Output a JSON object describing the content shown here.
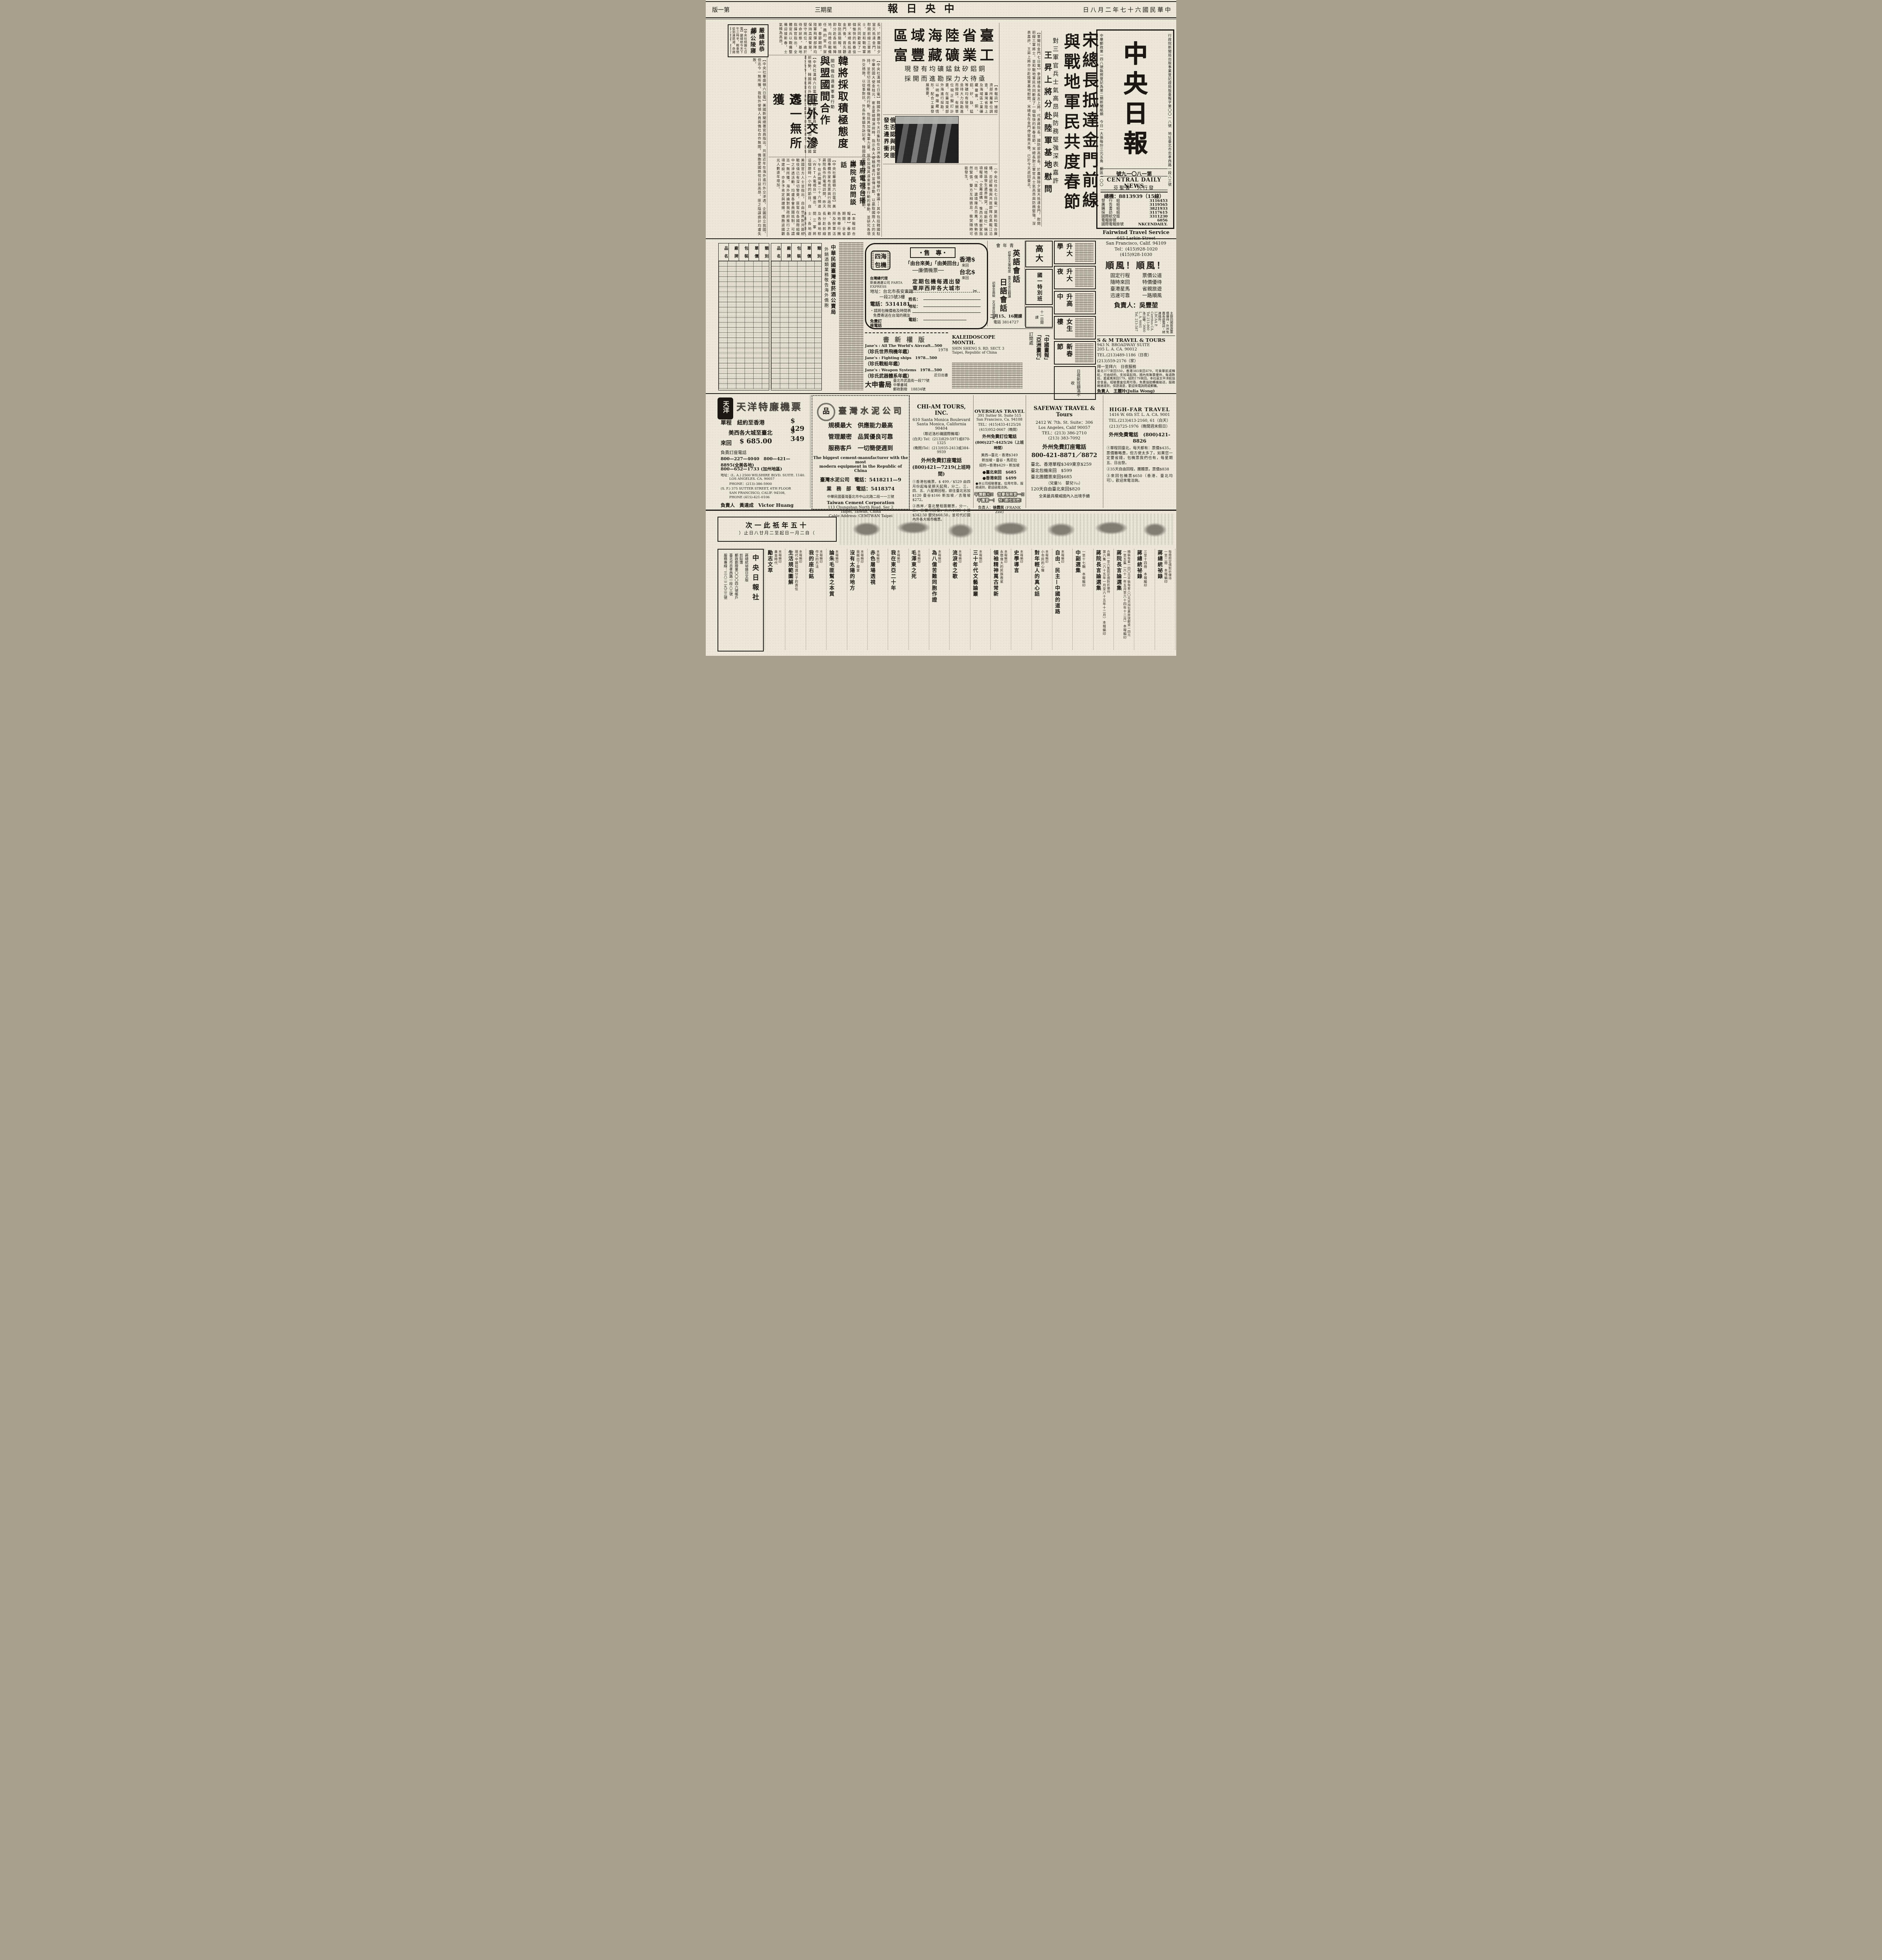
{
  "page": {
    "edition": "第一版",
    "weekday": "星期三",
    "title": "中央日報",
    "date": "中華民國六十七年二月八日"
  },
  "masthead": {
    "reg_line": "行政院新聞局出版事業登記證局版臺報字第〇〇一八號　地址臺北市忠孝西路一段八三號",
    "postal_line": "中華郵政第一四八號執照登記為第二類新聞紙類　今日一大張每份三元五角　郵區一〇〇",
    "big_title": "中央日報",
    "issue_no": "第一八〇一九號",
    "en_name": "CENTRAL DAILY NEWS",
    "publisher": "發行人　曹聖芬",
    "switchboard": "總機：8813939（15線）",
    "phones": [
      {
        "label": "發　行　組",
        "value": "3116453"
      },
      {
        "label": "廣　告　組",
        "value": "3119565"
      },
      {
        "label": "購　書　組",
        "value": "3821933"
      },
      {
        "label": "採　訪　組",
        "value": "3117615"
      },
      {
        "label": "國際航空版",
        "value": "3311230"
      },
      {
        "label": "電報掛號",
        "value": "6056"
      },
      {
        "label": "國際電報掛號",
        "value": "NKCENDAILY."
      }
    ]
  },
  "news": {
    "song": {
      "h1": "宋總長抵達金門前線",
      "h2": "與戰地軍民共度春節",
      "kicker": "對三軍官兵士氣高昂與防務堅強深表嘉許",
      "sub": "王昇上將分赴陸軍基地慰問",
      "body": "【軍聞社金門七日電】參謀總長宋長志上將，代表蔣院長、國防部高部長，於農曆除夕當天抵達金門，慰問前線三軍將士，並和戰地軍民共同歡度了一個愉快的新春佳節。宋總長對三軍官兵士氣高昂與防務堅強，深表嘉許。王昇上將亦分赴陸軍基地慰問。宋總長在金門停留兩天後，已於今天返回臺北。"
    },
    "minerals": {
      "h1": "臺省陸海域區",
      "h2": "工業礦藏豐富",
      "sub1": "銅鋁矽鈦錳礦均有發現",
      "sub2": "亟待大力探勘進而開採",
      "body": "【本報訊】據經濟部所屬單位調查，臺灣省陸上及海域區工業礦藏豐富，銅、鋁、矽、鈦、錳等礦均有發現，亟待大力探勘進而開採。有關單位現正擬訂計畫，在臺灣東部外海進行探勘，以明瞭蘊藏情形，配合工業發展需要。"
    },
    "korea": {
      "kicker": "關切俄在遠東軍事行動",
      "h1": "韓將採取積極態度",
      "h2": "與盟國間合作",
      "body": "【中央社漢城六日電】韓國政府官員表示，為因應當前情勢，韓國將在外交上採取積極態度，加強與盟國間之合作，對俄國在遠東之軍事行動深表關切。官員指出，韓國政府都能預先做好最高程度的外交準備。他警告說：由於北韓發現它在外交上無法與韓國競爭，故而可能會不擇手段地進行挑釁。"
    },
    "red": {
      "h1": "匪外交滲透",
      "h2": "迄一無所獲",
      "body": "【中央社華盛頓六日電】美國新聞總署官員指出，共匪近年在海外進行外交滲透，企圖孤立我國，但迄今一無所獲。我駐外使領人員與僑社合作無間，僑胞愛國熱忱日益高昂，匪之陰謀詭計均遭失敗。"
    },
    "yen": {
      "h1": "嚴總統恭謁",
      "h2": "蔣公陵寢",
      "body": "【中央社桃園七日電】嚴總統今天下午三時半，輕車簡從到達慈湖，恭謁　蔣公陵寢，獻花行禮致敬，傍晚離開慈湖返回臺北。"
    },
    "ussr": {
      "h1": "俄否認與共匪",
      "h2": "發生邊界衝突"
    },
    "tv": {
      "h1": "華府電視台播出",
      "h2": "蔣院長訪問談話",
      "body": "【中央社華盛頓六日電】美國專欄作家布克萊與行政院蔣院長作的電視訪問，昨天下午在此間第二十六頻道（ＷＥＴＡ電視台）播出。這個歷時一小時的節目，自昨天下午起連續播出。"
    },
    "excerpts": {
      "a": "長，於農曆除夕當天抵達金門，慰問前線三軍將士，並和戰地軍民共同歡度了一個愉快的新春佳節。宋總長抵達金門後，首先聽取防區簡報，隨即分赴各前哨陣地，向擔任戰備任務的官兵賀節。春節期間，陸軍飛彈部隊均保持高度警覺，堅守崗位，處於待命狀態。基地指揮官指出，全體官兵以戰備整備迎接新春，士氣極為高昂。",
      "b": "美國官方人士並指出，自由世界對共匪統戰伎倆已有深切警覺，匪幫在各國際組織中之滲透活動，均遭各會員國抵制，可謂迄一無所獲。海外輿論對我政府推行之各項建設，亦多予肯定與讚揚，僑胞返國觀光人數逐年增加。",
      "c": "【中央社漢城七日電】韓國外務部今天召集駐在亞洲各地的使節領袖舉行會議──其中包括韓國駐中華民國大使金桂元。崔圭夏總理演說時，指示各大使積極進行宣傳活動，以贏取國際人士的支持，並密切注視蘇俄的行動，包括其加強海軍力量、旨在加強其遠東軍事行動的舉動，並研究各項外交措施，以從事對抗。外長朴東鎮告訴記者，韓國政府正在密切注視蘇俄的行動。",
      "d": "〔中央社台北七日電〕莫斯科電台廣播，否認蘇俄與共匪部隊在黑龍江沿線地區發生邊界衝突，「塔斯社」稱這項報導「全屬虛構」。惟西方觀察家指出，俄「匪」邊境陳兵百萬，情勢依然緊張，雙方互相猜忌，衝突隨時可能發生。",
      "e": "【本報綜合報導】春節期間，全省各地舉行團拜及勞軍活動，各界首長分赴前線及各基地慰問三軍將士；各地遊樂場所遊人如織，呈現一片昇平景象。鐵公路局加開班車，疏運返鄉旅客；治安機關加強巡邏，確保假期安寧。"
    }
  },
  "ads_mid": {
    "monopoly": {
      "title1": "中華民國臺灣省菸酒公賣局",
      "title2": "外銷酒類業務敬告海外僑胞",
      "headers": [
        "品　名",
        "廠　牌",
        "包　裝",
        "單　價",
        "類　別"
      ]
    },
    "charter": {
      "stamp": "四海包機",
      "label": "・專　售・",
      "line1": "「由台來美」「由美回台」",
      "line2": "──廉價機票──",
      "fare1": "香港$",
      "fare1_tag": "來回",
      "fare2": "台北$",
      "fare2_tag": "來回",
      "sched1": "定期包機每週出發",
      "sched2": "東岸西岸各大城市",
      "agent": "台灣總代理",
      "agent2": "新美通運公司 FARTA EXPRESS",
      "addr1": "地址：台北市長安東路",
      "addr2": "一段25號3樓",
      "tel": "電話：5314181",
      "note1": "・請將包機價格及時間表",
      "note2": "免費寄送在台灣的親友",
      "coupon_name": "姓名：",
      "coupon_addr": "地址：",
      "coupon_tel": "電話：",
      "hotline1": "免費訂",
      "hotline2": "座電話",
      "scissors": "✂"
    },
    "ymca": {
      "org": "青年會",
      "c1": "英語會話",
      "c1_note": "初學至大專程度　重文法會話翻譯",
      "c2": "日語會話",
      "c2_note": "初學至高級　文法會話並重",
      "start": "二月15、16開課",
      "phone": "電話 3814727"
    },
    "cram": {
      "b1": "高大",
      "b2": "國一特別班",
      "b3": "十一日開課"
    },
    "classifieds": [
      "升大學",
      "升大夜",
      "升高中",
      "女生樓",
      "新春節",
      "日夜新班額滿不收"
    ],
    "fairwind": {
      "name": "Fairwind Travel Service",
      "addr1": "645 Larkin Street",
      "addr2": "San Francisco, Calif. 94109",
      "tel1": "Tel：(415)928-1020",
      "tel2": "(415)928-1030",
      "slogan": "順風！順風！",
      "features": [
        "固定行程",
        "票價公道",
        "隨時來回",
        "特價優待",
        "臺港星馬",
        "省親旅遊",
        "迅速可靠",
        "一路順風"
      ],
      "manager": "負責人：吳豐堃",
      "agents": "主辦回國旅遊票價優待・外州免費長途電話・總連絡所：LBCAA P. Cerritos CA. Tel 213-860　洛山磯：3660　L. A. 9001　Tel. 213-587"
    },
    "sm": {
      "name": "S & M TRAVEL & TOURS",
      "addr1": "943 N. BROADWAY SUITE",
      "addr2": "205 L. A. CA. 90012",
      "tel1": "TEL.(213)489-1186（日夜）",
      "tel2": "(213)559-2176（家）",
      "hours": "拜一至拜六　日夜服務",
      "body": "臺北377來回550，香港383來回479，可乘華航或韓航，可由紐約、支加哥起飛，國內有聯票優待，每週數班，夏威夷來回179，紐約179來回。本社是太平洋航協會會員，經驗豐富信用可靠，免費協助轉機接送，服務確速週到，保證滿意，歡迎來電詢問或郵購。",
      "manager": "負責人　王麗玲(Julia Wong)"
    },
    "books_new": {
      "title": "版權新書",
      "i1_en": "Jane's : All The World's Aircraft…500",
      "i1_zh": "（珍氏世界飛機年鑑）",
      "i1_yr": "1978",
      "i2_en": "Jane's : Fighting ships　1978…500",
      "i2_zh": "（珍氏戰船年鑑）",
      "i3_en": "Jane's : Weapon Systems　1978…500",
      "i3_zh": "（珍氏武器體系年鑑）",
      "i3_yr": "近日出書",
      "store": "大申書局",
      "store_addr": "臺北市武昌街一段77號",
      "store_addr2": "中華書城",
      "postal": "郵政劃撥　18834號"
    },
    "misc": {
      "l1": "「中國畫報」",
      "l2": "「亞洲畫刊」",
      "l3": "訂閱處",
      "en1": "KALEIDOSCOPE",
      "en2": "MONTH.",
      "en3": "SHIN SHENG S. RD. SECT. 3",
      "en4": "Taipei, Republic of China"
    }
  },
  "ads_bottom": {
    "tianyang": {
      "logo": "天洋",
      "title": "天洋特廉機票",
      "fare1": "單程　紐約至香港",
      "price1": "$ 429",
      "fare2": "美西各大城至臺北",
      "price2": "$ 349",
      "fare3": "來回",
      "price3": "$ 685.00",
      "booking": "負責訂座電話",
      "tel1": "800—227—4040　800—421—8895(全美各地)",
      "tel2": "800—652—1733 (加州地區)",
      "addr1": "地址：(L. A.) 2500 WILSHIRE BLVD. SUITE. 1140.",
      "addr2": "LOS ANGELES. CA. 90057",
      "tel3": "PHONE：(213)-386-5900",
      "addr3": "(S. F.) 375 SUTTER STREET, 6TH FLOOR",
      "addr4": "SAN FRANCISCO, CALIF. 94108,",
      "tel4": "PHONE (415)-421-0106",
      "manager": "負責人　黃達成　Victor Huang"
    },
    "cement": {
      "title": "臺灣水泥公司",
      "logo_glyph": "品",
      "s1": "規模最大　供應能力最高",
      "s2": "管理嚴密　品質優良可靠",
      "s3": "服務客戶　一切簡便週到",
      "en1": "The biggest cement-manufacturer with the most",
      "en2": "modern equipment in the Republic of China",
      "tel1": "臺灣水泥公司　電話：5418211—9",
      "tel2": "業　務　部　電話：5418374",
      "zh_addr": "中華民國臺灣臺北市中山北路二段一一三號",
      "en_name": "Taiwan Cement Corporation",
      "en_addr1": "113 Chungshan North Road. Sec 2",
      "en_addr2": "Taipei, Taiwan, China",
      "cable": "Cable Address: CEMTWAN Taipei"
    },
    "chiam": {
      "name": "CHI-AM TOURS, INC.",
      "addr1": "610 Santa Monica Boulevard",
      "addr2": "Santa Monica, California 90404",
      "note": "（鄰近洛杉磯國際機場）",
      "tel1": "(白天) Tel：(213)829-5971或870-1325",
      "tel2": "(晚間)Tel：(213)935-2413或384-9939",
      "tollfree_label": "外州免費訂座電話",
      "tollfree": "(800)421—7219(上班時間)",
      "item1": "①香港包機票，$ 499／$529 由四月份起每星期天起飛，分二、三、四、五、六星期回程，欲往臺北另加$120 曼谷$166 新加坡／吉隆坡$272。",
      "item2": "②西岸／臺北雙程團體票，分一、二、三個月回程，大人$685 小孩$342.50 嬰兒$68.50，並可代訂國內外各大城市機票。"
    },
    "overseas": {
      "name": "OVERSEAS TRAVEL",
      "addr1": "391 Sutter St. Suite 515",
      "addr2": "San Francisco, Ca. 94108",
      "tel1": "TEL：(415)433-4125/26",
      "tel2": "(415)952-0667（晚間）",
      "tollfree_label": "外州免費訂位電話",
      "tollfree": "(800)227-4425/26（上班時間）",
      "fare1": "美西→臺北・香港$349",
      "fare2": "新加坡・曼谷・馬尼拉",
      "fare3": "紐約→香港$429・新加坡",
      "fare4": "●臺北來回　$685",
      "fare5": "●香港來回　$499",
      "note": "●本公司經驗豐富，信用可靠，服務週到，歡迎函電洽詢。",
      "slogan1": "平價觀光!!　信譽服務第一!!",
      "slogan2": "平價第一!　快!請找我們!",
      "manager_label": "負責人：",
      "manager": "徐霖民",
      "manager_en": "(FRANK Zee)"
    },
    "safeway": {
      "name": "SAFEWAY TRAVEL & Tours",
      "addr1": "2412 W. 7th. St. Suite：306",
      "addr2": "Los Angeles, Calif 90057",
      "tel1": "TEL：(213) 386-2710",
      "tel2": "(213) 383-7092",
      "tollfree_label": "外州免費訂座電話",
      "tollfree": "800-421-8871／8872",
      "f1": "臺北、香港單程$349東京$259",
      "f2": "臺北包機來回　$599",
      "f3": "臺北團體票來回$685",
      "f4": "（兒童½　嬰兒⅒）",
      "f5": "120天自由臺北來回$820",
      "f6": "全美最具權威國內入出境手續"
    },
    "highfar": {
      "name": "HIGH-FAR TRAVEL",
      "addr": "1416 W. 6th ST. L. A. CA. 9001",
      "tel1": "TEL.(213)413-2160, 61（白天）",
      "tel2": "(213)725-1976（晚間週末假日）",
      "tollfree": "外州免費電話　(800)421-8826",
      "item1": "①單程回臺北，每天都有：票價$435，票價雖略貴，但方便太多了。如果您一定要省錢，包機票我們也有，每星期五、日出發。",
      "item2": "②35天自由回程，團體票，票價$838",
      "item3": "③來回包機票$650（香港、臺北均可），歡迎來電洽詢。"
    }
  },
  "books": {
    "sale_note1": "十五年祇此一次",
    "sale_note2": "（自二月一日起至二月廿八日止）",
    "press": {
      "name": "中央日報社",
      "l1": "蔣總統祕錄日文版",
      "l2": "剪貼簿",
      "l3": "郵政劃撥第〇〇〇四六號帳戶",
      "l4": "臺北市忠孝西路一段八三號",
      "l5": "服務專線：三八二二九三三號"
    },
    "items": [
      {
        "t": "蔣總統祕錄",
        "s": "一至二冊　本報編印",
        "n": "每冊照定價對折優待"
      },
      {
        "t": "蔣總統祕錄",
        "s": "三至十四冊　本報編印",
        "n": "合購一至十四冊照定價對折優待　精裝每套三四五元平裝每套一七〇元另加包裹掛號郵資一四元"
      },
      {
        "t": "蔣院長言論選集",
        "s": "一至五集（六十一年五月至六十四年十二月）本報編印",
        "n": "精裝每套一四〇元平裝每套八〇元另加包裹掛號郵資一四元"
      },
      {
        "t": "蔣院長言論選集",
        "s": "第六集（六十五年一月至六十五年十二月）本報編印",
        "n": "合購一至六集照定價對折優待"
      },
      {
        "t": "中副選集",
        "s": "一至十七輯　本報編印",
        "n": "合購一至十七輯照定價對折優待　精裝每套四二五元平裝每套二九七元另加包裹掛號郵資一四元"
      },
      {
        "t": "自由、民主—中國的道路",
        "s": "",
        "n": "本報編印"
      },
      {
        "t": "對年輕人的真心話",
        "s": "小市民的心聲",
        "n": "本報編印"
      },
      {
        "t": "史學導言",
        "s": "",
        "n": "本報編印"
      },
      {
        "t": "領袖精神萬古常新",
        "s": "永懷偉大的民族救星",
        "n": "本報編印"
      },
      {
        "t": "三十年代文藝論叢",
        "s": "",
        "n": "本報編印"
      },
      {
        "t": "流淚者之歌",
        "s": "",
        "n": "本報編印"
      },
      {
        "t": "為八億苦難同胞作證",
        "s": "",
        "n": "本報編印"
      },
      {
        "t": "毛澤東之死",
        "s": "",
        "n": "本報編印"
      },
      {
        "t": "我在東亞二十年",
        "s": "",
        "n": "本報編印"
      },
      {
        "t": "赤色屠場透視",
        "s": "",
        "n": "本報編印"
      },
      {
        "t": "沒有太陽的地方",
        "s": "我衝出了魔掌",
        "n": "本報編印"
      },
      {
        "t": "論朱毛匪幫之本質",
        "s": "",
        "n": "本報編印"
      },
      {
        "t": "我的座右銘",
        "s": "作文的方法",
        "n": "本報編印"
      },
      {
        "t": "生活規範圖解",
        "s": "現代中國知識分子的責任",
        "n": "本報編印"
      },
      {
        "t": "勵志文萃",
        "s": "黃金時代",
        "n": "本報編印"
      }
    ]
  }
}
